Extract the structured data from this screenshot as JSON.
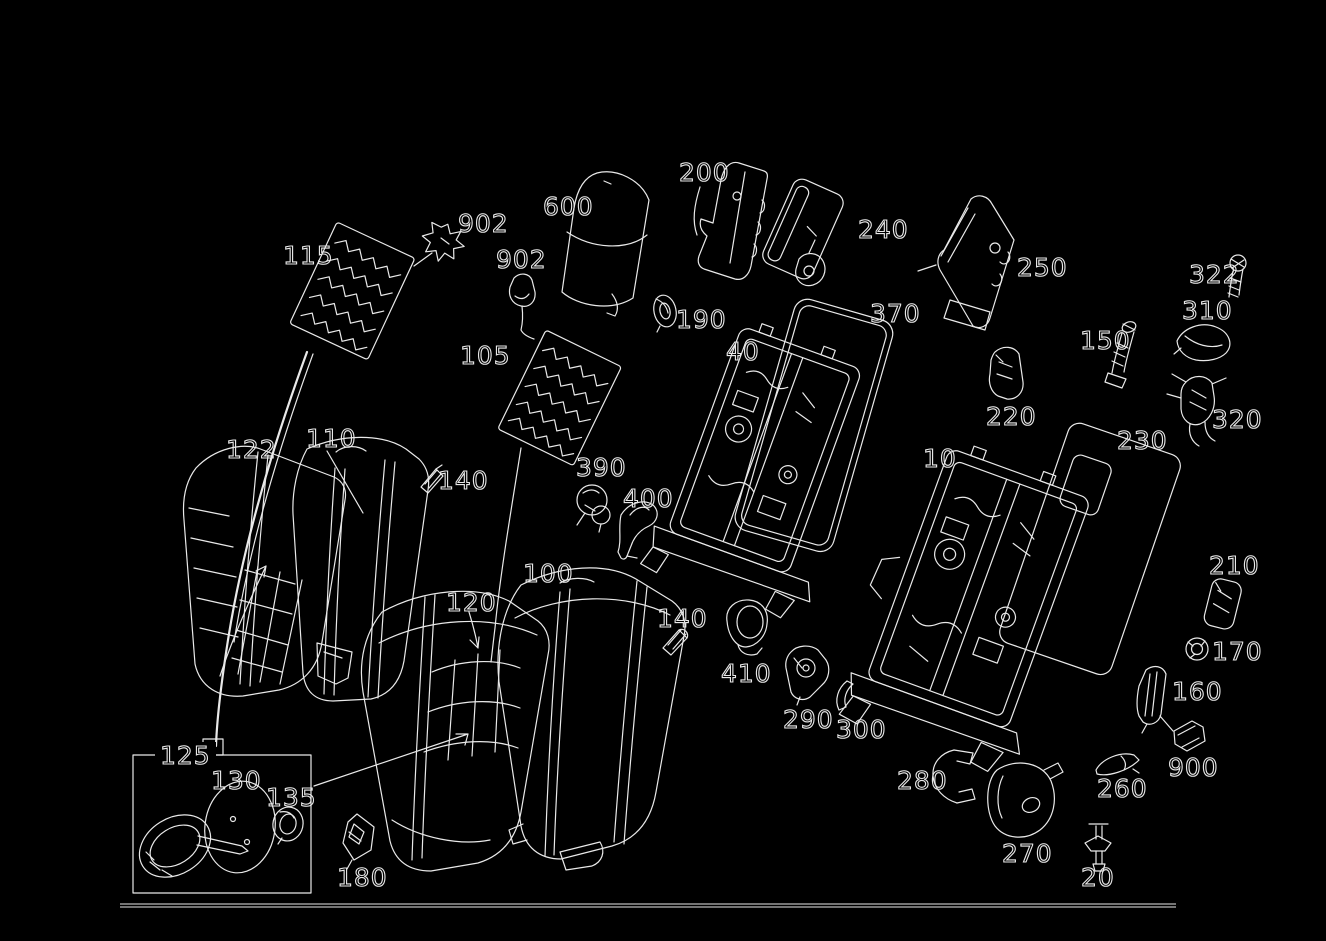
{
  "figure": {
    "background_color": "#000000",
    "line_color": "#e9e9e9",
    "kind": "exploded-parts-diagram"
  },
  "inset_box": {
    "label": "125"
  },
  "baseline": {
    "x1": 120,
    "x2": 1176,
    "y": 904
  },
  "labels": [
    {
      "id": "115",
      "text": "115",
      "x": 283,
      "y": 242
    },
    {
      "id": "902-upper",
      "text": "902",
      "x": 458,
      "y": 210
    },
    {
      "id": "902-lower",
      "text": "902",
      "x": 496,
      "y": 246
    },
    {
      "id": "600",
      "text": "600",
      "x": 543,
      "y": 193
    },
    {
      "id": "200",
      "text": "200",
      "x": 679,
      "y": 159
    },
    {
      "id": "240",
      "text": "240",
      "x": 858,
      "y": 216
    },
    {
      "id": "250",
      "text": "250",
      "x": 1017,
      "y": 254
    },
    {
      "id": "322",
      "text": "322",
      "x": 1189,
      "y": 261
    },
    {
      "id": "310",
      "text": "310",
      "x": 1182,
      "y": 297
    },
    {
      "id": "150",
      "text": "150",
      "x": 1080,
      "y": 327
    },
    {
      "id": "320",
      "text": "320",
      "x": 1212,
      "y": 406
    },
    {
      "id": "190",
      "text": "190",
      "x": 676,
      "y": 306
    },
    {
      "id": "370",
      "text": "370",
      "x": 870,
      "y": 300
    },
    {
      "id": "40",
      "text": "40",
      "x": 726,
      "y": 338
    },
    {
      "id": "220",
      "text": "220",
      "x": 986,
      "y": 403
    },
    {
      "id": "230",
      "text": "230",
      "x": 1117,
      "y": 427
    },
    {
      "id": "10",
      "text": "10",
      "x": 923,
      "y": 445
    },
    {
      "id": "122",
      "text": "122",
      "x": 226,
      "y": 436
    },
    {
      "id": "110",
      "text": "110",
      "x": 306,
      "y": 425
    },
    {
      "id": "140-upper",
      "text": "140",
      "x": 438,
      "y": 467
    },
    {
      "id": "105",
      "text": "105",
      "x": 460,
      "y": 342
    },
    {
      "id": "390",
      "text": "390",
      "x": 576,
      "y": 454
    },
    {
      "id": "400",
      "text": "400",
      "x": 623,
      "y": 485
    },
    {
      "id": "100",
      "text": "100",
      "x": 523,
      "y": 560
    },
    {
      "id": "120",
      "text": "120",
      "x": 446,
      "y": 589
    },
    {
      "id": "140-lower",
      "text": "140",
      "x": 657,
      "y": 605
    },
    {
      "id": "410",
      "text": "410",
      "x": 721,
      "y": 660
    },
    {
      "id": "290",
      "text": "290",
      "x": 783,
      "y": 706
    },
    {
      "id": "300",
      "text": "300",
      "x": 836,
      "y": 716
    },
    {
      "id": "280",
      "text": "280",
      "x": 897,
      "y": 767
    },
    {
      "id": "270",
      "text": "270",
      "x": 1002,
      "y": 840
    },
    {
      "id": "210",
      "text": "210",
      "x": 1209,
      "y": 552
    },
    {
      "id": "170",
      "text": "170",
      "x": 1212,
      "y": 638
    },
    {
      "id": "160",
      "text": "160",
      "x": 1172,
      "y": 678
    },
    {
      "id": "900",
      "text": "900",
      "x": 1168,
      "y": 754
    },
    {
      "id": "260",
      "text": "260",
      "x": 1097,
      "y": 775
    },
    {
      "id": "20",
      "text": "20",
      "x": 1081,
      "y": 864
    },
    {
      "id": "125",
      "text": "125",
      "x": 155,
      "y": 742
    },
    {
      "id": "130",
      "text": "130",
      "x": 211,
      "y": 767
    },
    {
      "id": "135",
      "text": "135",
      "x": 266,
      "y": 784
    },
    {
      "id": "180",
      "text": "180",
      "x": 337,
      "y": 864
    }
  ]
}
